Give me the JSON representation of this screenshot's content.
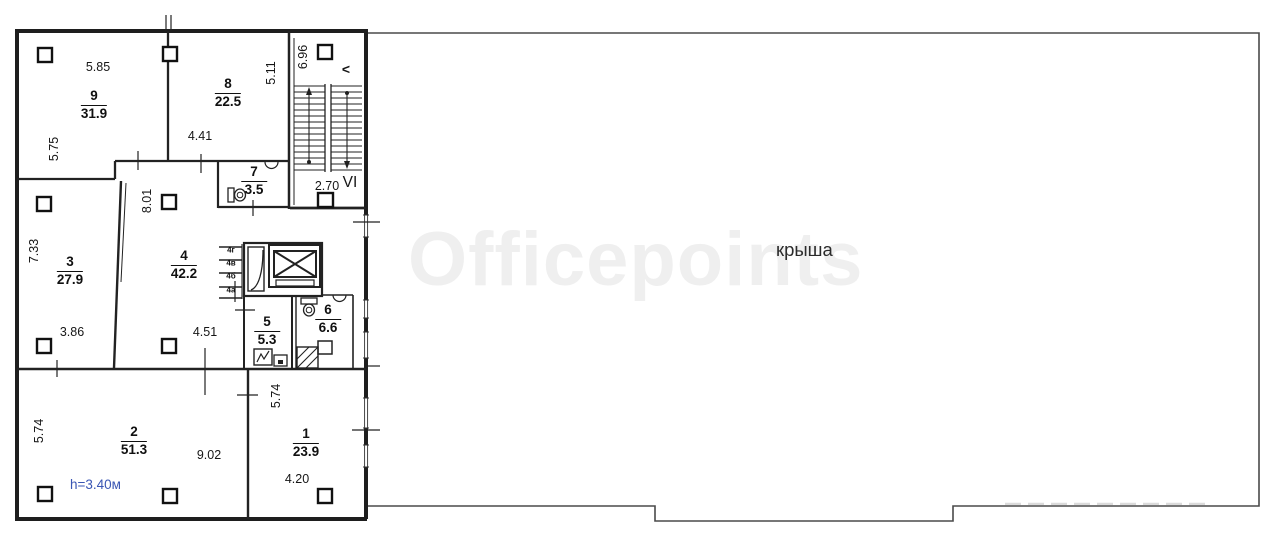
{
  "watermark": {
    "text": "Officepoints",
    "color": "#efefef"
  },
  "roof": {
    "label": "крыша"
  },
  "rooms": [
    {
      "number": "9",
      "area": "31.9"
    },
    {
      "number": "8",
      "area": "22.5"
    },
    {
      "number": "7",
      "area": "3.5"
    },
    {
      "number": "3",
      "area": "27.9"
    },
    {
      "number": "4",
      "area": "42.2"
    },
    {
      "number": "5",
      "area": "5.3"
    },
    {
      "number": "6",
      "area": "6.6"
    },
    {
      "number": "2",
      "area": "51.3"
    },
    {
      "number": "1",
      "area": "23.9"
    }
  ],
  "dimensions": {
    "room9_top": "5.85",
    "room9_left": "5.75",
    "room8_bottom": "4.41",
    "room8_right": "5.11",
    "stair_width": "6.96",
    "room4_left": "8.01",
    "room3_left": "7.33",
    "room3_bottom": "3.86",
    "room4_bottom": "4.51",
    "landing_width": "2.70",
    "stair_section": "VI",
    "room2_left": "5.74",
    "room2_bottom": "9.02",
    "room1_left": "5.74",
    "room1_bottom": "4.20"
  },
  "shaft_labels": [
    "4г",
    "4в",
    "4б",
    "4а"
  ],
  "annotations": {
    "ceiling_height": "h=3.40м",
    "ceiling_height_color": "#3a56b4",
    "stair_direction_mark": "<"
  }
}
